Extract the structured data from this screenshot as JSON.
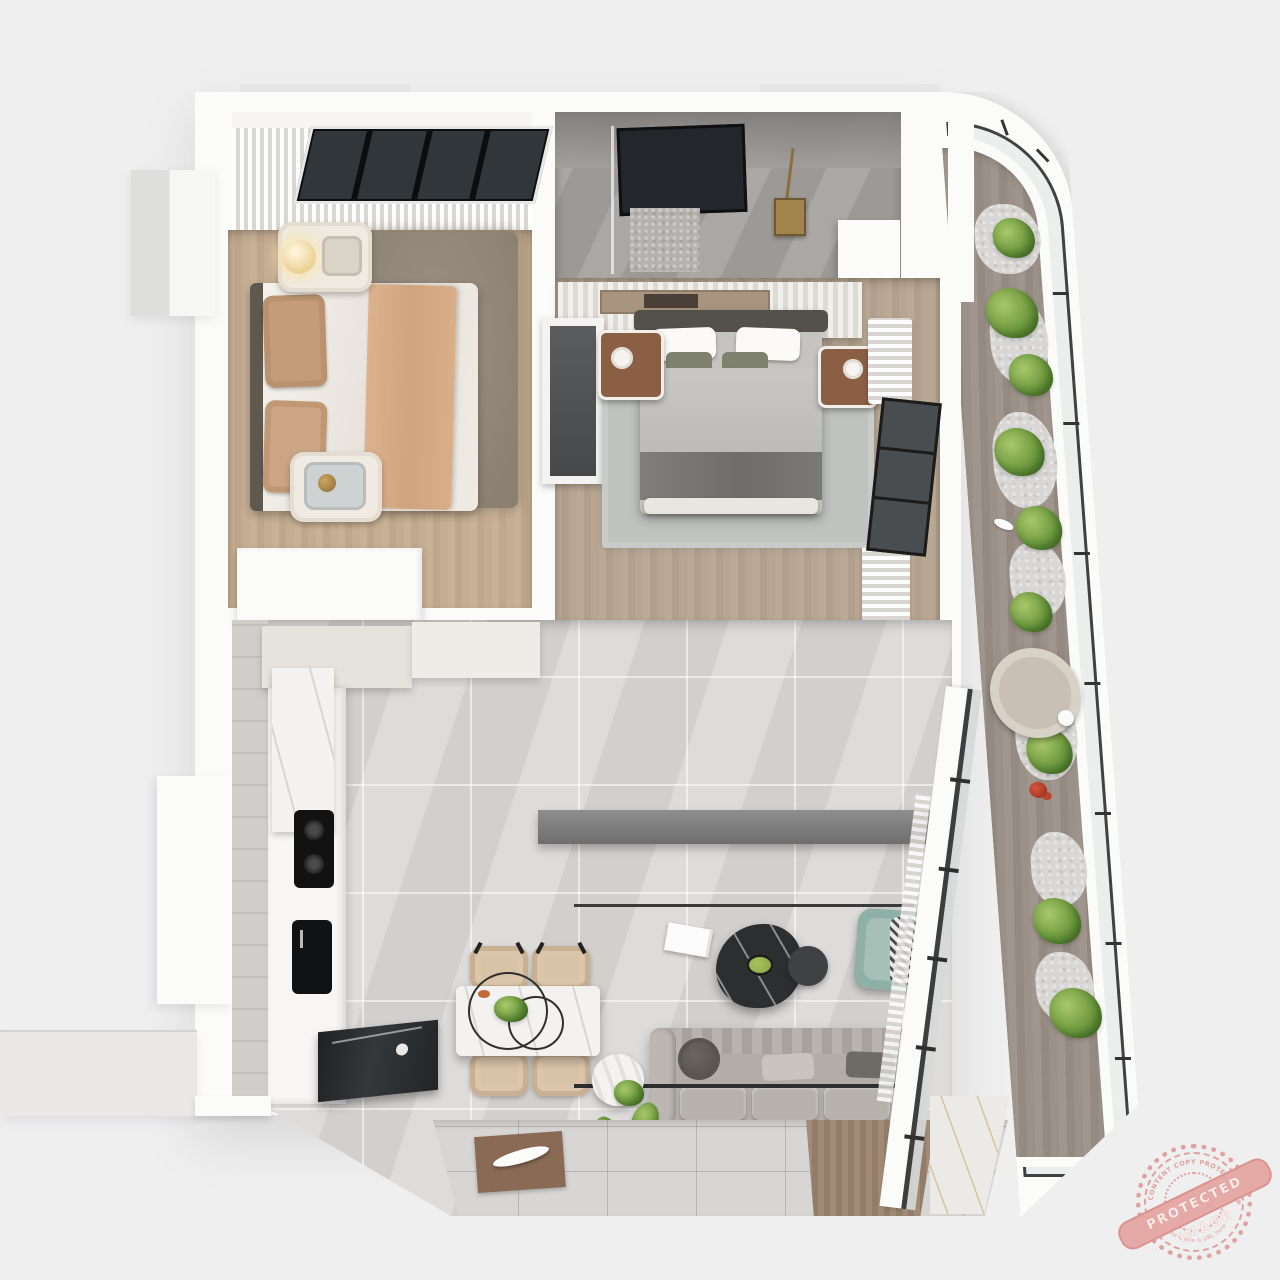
{
  "scene": {
    "type": "3d-isometric-floorplan-render",
    "description": "Top-down 3D render of an apartment: bedroom with skylight top-left, master bathroom top-middle, master bedroom center, curved planted balcony on the right, kitchen nook and vanity bathroom in the middle strip, open kitchen / dining / living room at the bottom, entry platform bottom-left",
    "background_color": "#efeff0"
  },
  "palette": {
    "wall": "#fbfbfa",
    "bedroom_wood": "#c4ab90",
    "master_wood": "#b5a38e",
    "balcony_deck": "#998f87",
    "living_marble": "#d8d6d4",
    "bath_marble": "#a3a09e",
    "shag_rug": "#95897c",
    "master_rug": "#bfc2bf",
    "sofa": "#b2ada8",
    "teal_armchair": "#8fb0a6",
    "dining_chair": "#d9c3a7",
    "black_marble": "#2b2d2f",
    "plant_green": "#6f9a3f",
    "brass": "#8a6f3f",
    "watermark_pink": "#dd9191"
  },
  "rooms": [
    {
      "id": "bedroom-1",
      "name": "Bedroom",
      "floor": "light oak planks",
      "items": [
        "double bed with tan and white bedding",
        "headboard wall panel",
        "globe wall lamp",
        "two cream nightstands",
        "gold kettle tray",
        "gray shag rug",
        "skylight window with sheer curtains",
        "white cabinet"
      ]
    },
    {
      "id": "master-bathroom",
      "name": "Master bathroom",
      "floor": "gray marble",
      "items": [
        "dark vanity mirror",
        "brass shower set",
        "mosaic shower floor",
        "glass partition"
      ]
    },
    {
      "id": "master-bedroom",
      "name": "Master bedroom",
      "floor": "oak planks",
      "items": [
        "double bed with gray duvet",
        "white pillows",
        "foot bench",
        "two walnut nightstands",
        "slatted closet",
        "dark wardrobe",
        "light gray area rug",
        "window with sheer curtains"
      ]
    },
    {
      "id": "kitchen-nook",
      "name": "Kitchen nook",
      "floor": "gray marble",
      "items": [
        "counter with sink and faucet",
        "serving trays"
      ]
    },
    {
      "id": "bathroom-2",
      "name": "Vanity bathroom",
      "floor": "gray marble",
      "items": [
        "lighted vanity mirror",
        "round mirror",
        "shower screen",
        "white table lamp",
        "vanity counter"
      ]
    },
    {
      "id": "kitchen",
      "name": "Kitchen",
      "floor": "marble tile",
      "items": [
        "cream upper cabinets",
        "marble counter",
        "black cooktop",
        "black sink",
        "dark marble island"
      ]
    },
    {
      "id": "living-dining",
      "name": "Living / dining room",
      "floor": "light marble tile",
      "items": [
        "marble dining table",
        "wire-ring table sculpture",
        "four tan dining chairs",
        "black marble coffee table",
        "round side table",
        "white book",
        "teal armchair with throw",
        "three-seat gray sofa with cushions",
        "round marble side table with plant",
        "ceiling track lights",
        "area rug",
        "wood runner",
        "brown mat with white sculpture",
        "gold-vein marble floor patch"
      ]
    },
    {
      "id": "balcony",
      "name": "Balcony",
      "floor": "wood deck",
      "items": [
        "curved glass railing with black frame",
        "white pebble border",
        "green shrubs",
        "red flowers",
        "white bird ornament",
        "round lounge chair",
        "small side table"
      ]
    },
    {
      "id": "entry",
      "name": "Entry",
      "floor": "white platform",
      "items": [
        "entry step platform"
      ]
    }
  ],
  "watermark": {
    "banner_text": "PROTECTED IMAGE",
    "arc_top_text": "CONTENT COPY PROTECTION PLUGIN",
    "arc_bottom_text": "by Website Name & URL here",
    "color": "#dd9191"
  }
}
